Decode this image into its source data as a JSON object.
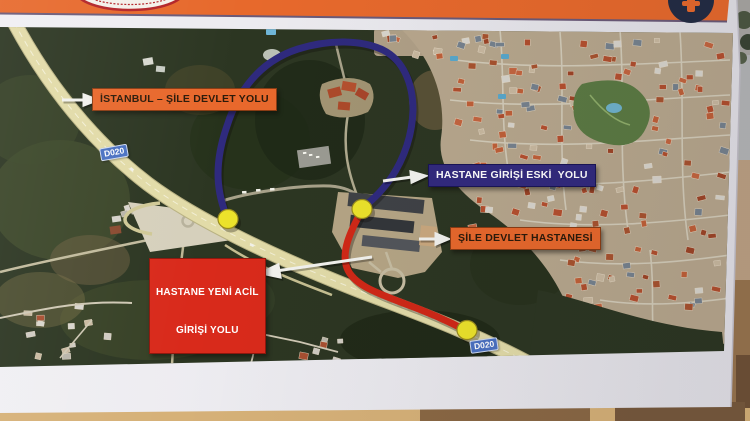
{
  "sign": {
    "header": {
      "bg_color": "#e7692c",
      "left_logo": "scalloped-oval-emblem",
      "right_logo": "dark-circle-orange-mark-emblem"
    },
    "callouts": [
      {
        "id": "istanbul-sile-road",
        "text": "İSTANBUL – ŞİLE DEVLET YOLU",
        "style": "orange"
      },
      {
        "id": "old-hospital-entrance-road",
        "text": "HASTANE GİRİŞİ ESKİ  YOLU",
        "style": "navy"
      },
      {
        "id": "sile-state-hospital",
        "text": "ŞİLE DEVLET HASTANESİ",
        "style": "orange"
      },
      {
        "id": "new-emergency-entrance-road",
        "line1": "HASTANE YENİ ACİL",
        "line2": "GİRİŞİ YOLU",
        "style": "red"
      }
    ],
    "road_badges": [
      {
        "text": "D020"
      },
      {
        "text": "D020"
      }
    ],
    "routes": [
      {
        "name": "hastane-girisi-eski-yolu",
        "color": "#2f2a7e"
      },
      {
        "name": "hastane-yeni-acil-girisi-yolu",
        "color": "#d02817"
      }
    ],
    "markers": {
      "count": 3,
      "color": "#ece32b"
    },
    "colors": {
      "header_orange": "#e7692c",
      "callout_orange": "#e8682c",
      "callout_navy": "#322a7e",
      "callout_red": "#d92a1b",
      "route_blue": "#2f2a7e",
      "route_red": "#d02817",
      "marker_yellow": "#ece32b",
      "badge_blue": "#4a71c2"
    }
  }
}
